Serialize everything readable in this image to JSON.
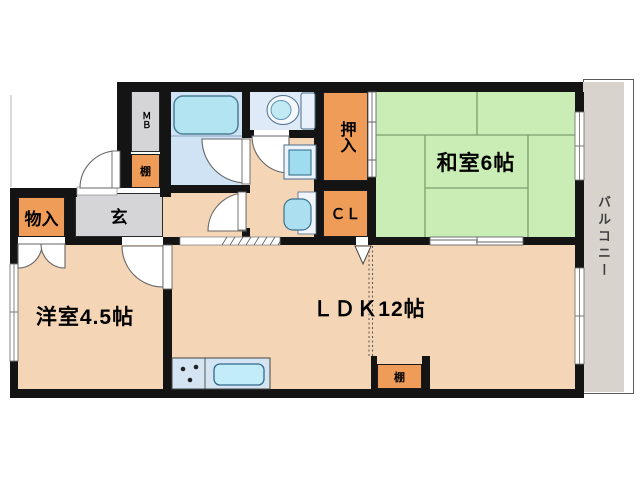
{
  "floorplan": {
    "rooms": {
      "washitsu": {
        "label": "和室6帖"
      },
      "yoshitsu": {
        "label": "洋室4.5帖"
      },
      "ldk": {
        "label": "ＬＤＫ12帖"
      },
      "balcony": {
        "label": "バルコニー"
      },
      "genkan": {
        "label": "玄"
      },
      "storage": {
        "label": "物入"
      },
      "oshiire": {
        "label": "押入"
      },
      "closet": {
        "label": "ＣＬ"
      },
      "meter_box": {
        "label": "ＭＢ"
      },
      "shelf_hall": {
        "label": "棚"
      },
      "shelf_ldk": {
        "label": "棚"
      }
    },
    "colors": {
      "wall": "#141414",
      "tatami_room": "#C9EDB5",
      "tatami_line": "#7CA06E",
      "flooring": "#F4D5B5",
      "closet_orange": "#F09C59",
      "entry_gray": "#D5D5D7",
      "bath_blue": "#CFE3F4",
      "toilet_blue": "#DEEAF8",
      "fixture_blue": "#AEE2F2",
      "balcony_gray": "#D9D3CE"
    }
  }
}
